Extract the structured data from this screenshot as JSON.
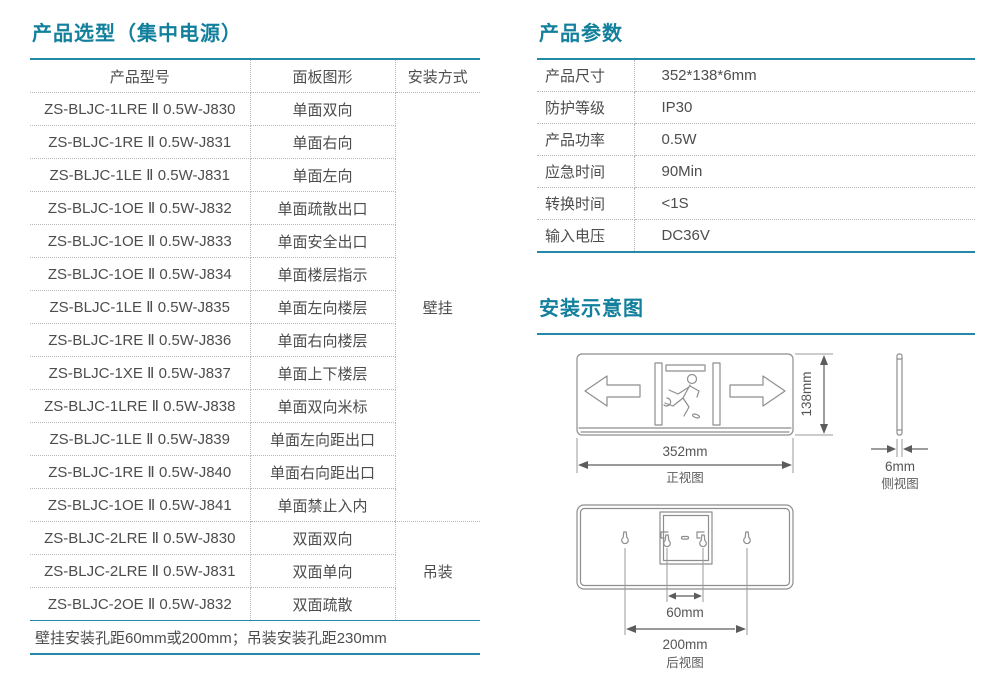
{
  "colors": {
    "accent_title": "#12809c",
    "accent_line": "#2389a8",
    "body_text": "#4d4d4d",
    "dotted_border": "#b8b8b8",
    "diagram_stroke": "#8e8e8e",
    "dimension_text": "#5c5c5c"
  },
  "left_section": {
    "title": "产品选型（集中电源）",
    "table": {
      "headers": [
        "产品型号",
        "面板图形",
        "安装方式"
      ],
      "rows": [
        {
          "model": "ZS-BLJC-1LRE Ⅱ 0.5W-J830",
          "panel": "单面双向"
        },
        {
          "model": "ZS-BLJC-1RE Ⅱ 0.5W-J831",
          "panel": "单面右向"
        },
        {
          "model": "ZS-BLJC-1LE Ⅱ 0.5W-J831",
          "panel": "单面左向"
        },
        {
          "model": "ZS-BLJC-1OE Ⅱ 0.5W-J832",
          "panel": "单面疏散出口"
        },
        {
          "model": "ZS-BLJC-1OE Ⅱ 0.5W-J833",
          "panel": "单面安全出口"
        },
        {
          "model": "ZS-BLJC-1OE Ⅱ 0.5W-J834",
          "panel": "单面楼层指示"
        },
        {
          "model": "ZS-BLJC-1LE Ⅱ 0.5W-J835",
          "panel": "单面左向楼层"
        },
        {
          "model": "ZS-BLJC-1RE Ⅱ 0.5W-J836",
          "panel": "单面右向楼层"
        },
        {
          "model": "ZS-BLJC-1XE Ⅱ 0.5W-J837",
          "panel": "单面上下楼层"
        },
        {
          "model": "ZS-BLJC-1LRE Ⅱ 0.5W-J838",
          "panel": "单面双向米标"
        },
        {
          "model": "ZS-BLJC-1LE Ⅱ 0.5W-J839",
          "panel": "单面左向距出口"
        },
        {
          "model": "ZS-BLJC-1RE Ⅱ 0.5W-J840",
          "panel": "单面右向距出口"
        },
        {
          "model": "ZS-BLJC-1OE Ⅱ 0.5W-J841",
          "panel": "单面禁止入内"
        },
        {
          "model": "ZS-BLJC-2LRE Ⅱ 0.5W-J830",
          "panel": "双面双向"
        },
        {
          "model": "ZS-BLJC-2LRE Ⅱ 0.5W-J831",
          "panel": "双面单向"
        },
        {
          "model": "ZS-BLJC-2OE Ⅱ 0.5W-J832",
          "panel": "双面疏散"
        }
      ],
      "mount_groups": [
        {
          "label": "壁挂",
          "start": 0,
          "span": 13
        },
        {
          "label": "吊装",
          "start": 13,
          "span": 3
        }
      ],
      "footer": "壁挂安装孔距60mm或200mm；吊装安装孔距230mm"
    }
  },
  "params_section": {
    "title": "产品参数",
    "rows": [
      {
        "label": "产品尺寸",
        "value": "352*138*6mm"
      },
      {
        "label": "防护等级",
        "value": "IP30"
      },
      {
        "label": "产品功率",
        "value": "0.5W"
      },
      {
        "label": "应急时间",
        "value": "90Min"
      },
      {
        "label": "转换时间",
        "value": "<1S"
      },
      {
        "label": "输入电压",
        "value": "DC36V"
      }
    ]
  },
  "diagram_section": {
    "title": "安装示意图",
    "front_view": {
      "label": "正视图",
      "width_dim": "352mm",
      "height_dim": "138mm"
    },
    "side_view": {
      "label": "侧视图",
      "thickness_dim": "6mm"
    },
    "rear_view": {
      "label": "后视图",
      "inner_hole_dim": "60mm",
      "outer_hole_dim": "200mm"
    }
  }
}
